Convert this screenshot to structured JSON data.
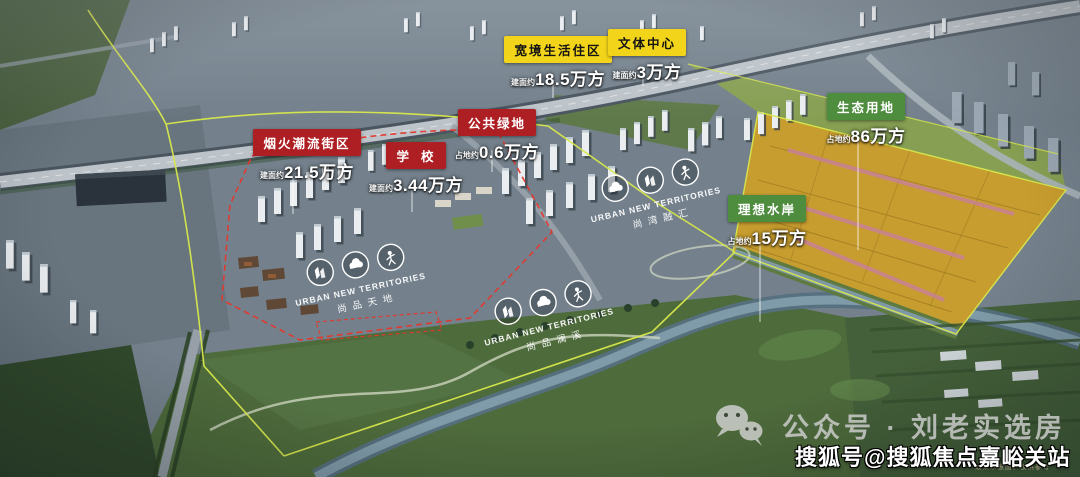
{
  "colors": {
    "badge_yellow": "#f2d41a",
    "badge_red": "#ae1f24",
    "badge_green": "#4e8c3e",
    "boundary_yellow": "#d8e84c",
    "boundary_red": "#e4372c",
    "value_text": "#ffffff"
  },
  "labels": [
    {
      "text": "宽境生活住区",
      "prefix": "建面约",
      "value": "18.5万方",
      "type": "yellow"
    },
    {
      "text": "文体中心",
      "prefix": "建面约",
      "value": "3万方",
      "type": "yellow"
    },
    {
      "text": "公共绿地",
      "prefix": "占地约",
      "value": "0.6万方",
      "type": "red"
    },
    {
      "text": "烟火潮流街区",
      "prefix": "建面约",
      "value": "21.5万方",
      "type": "red"
    },
    {
      "text": "学校",
      "prefix": "建面约",
      "value": "3.44万方",
      "type": "red"
    },
    {
      "text": "生态用地",
      "prefix": "占地约",
      "value": "86万方",
      "type": "green"
    },
    {
      "text": "理想水岸",
      "prefix": "占地约",
      "value": "15万方",
      "type": "green"
    }
  ],
  "logos": [
    {
      "en": "URBAN NEW TERRITORIES",
      "cn": "尚品天地"
    },
    {
      "en": "URBAN NEW TERRITORIES",
      "cn": "尚湾融汇"
    },
    {
      "en": "URBAN NEW TERRITORIES",
      "cn": "尚品澜溪"
    }
  ],
  "icons": {
    "wechat": "chat-bubbles",
    "logo_badges": [
      "building",
      "cloud",
      "person"
    ]
  },
  "watermarks": {
    "wechat_label": "公众号 · 刘老实选房",
    "sohu_label": "搜狐号@搜狐焦点嘉峪关站",
    "disclaimer": "效果示意图，仅供参考"
  }
}
